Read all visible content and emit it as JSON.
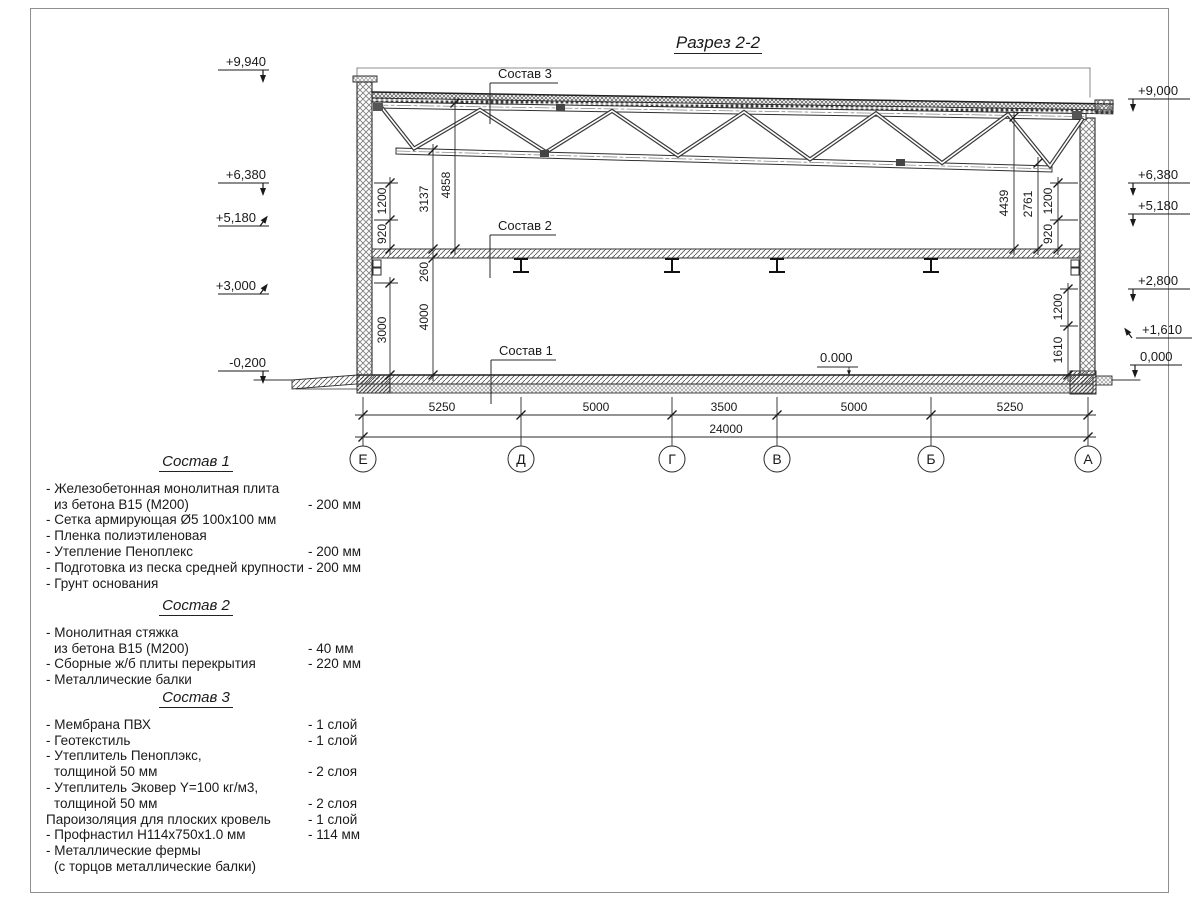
{
  "page": {
    "title": "Разрез 2-2"
  },
  "section_labels": {
    "sostav3": "Состав 3",
    "sostav2": "Состав 2",
    "sostav1": "Состав 1",
    "zero": "0.000"
  },
  "elevations": {
    "left": [
      "+9,940",
      "+6,380",
      "+5,180",
      "+3,000",
      "-0,200"
    ],
    "right": [
      "+9,000",
      "+6,380",
      "+5,180",
      "+2,800",
      "+1,610",
      "0,000"
    ]
  },
  "dimensions": {
    "left_upper": [
      "1200",
      "920",
      "3137",
      "4858"
    ],
    "left_lower": [
      "260",
      "3000",
      "4000"
    ],
    "right_upper": [
      "4439",
      "2761",
      "1200",
      "920"
    ],
    "right_lower": [
      "1200",
      "1610"
    ],
    "bottom": [
      "5250",
      "5000",
      "3500",
      "5000",
      "5250"
    ],
    "total": "24000"
  },
  "axes": [
    "Е",
    "Д",
    "Г",
    "В",
    "Б",
    "А"
  ],
  "compositions": [
    {
      "heading": "Состав 1",
      "rows": [
        {
          "text": "- Железобетонная  монолитная плита",
          "value": ""
        },
        {
          "text": "из бетона  В15 (М200)",
          "value": "- 200 мм"
        },
        {
          "text": "- Сетка армирующая Ø5 100х100 мм",
          "value": ""
        },
        {
          "text": "- Пленка полиэтиленовая",
          "value": ""
        },
        {
          "text": "- Утепление Пеноплекс",
          "value": "- 200 мм"
        },
        {
          "text": "- Подготовка из песка средней  крупности",
          "value": "- 200 мм"
        },
        {
          "text": "- Грунт основания",
          "value": ""
        }
      ]
    },
    {
      "heading": "Состав 2",
      "rows": [
        {
          "text": "- Монолитная стяжка",
          "value": ""
        },
        {
          "text": "из бетона В15 (М200)",
          "value": "- 40 мм"
        },
        {
          "text": "- Сборные ж/б плиты перекрытия",
          "value": "- 220 мм"
        },
        {
          "text": "- Металлические балки",
          "value": ""
        }
      ]
    },
    {
      "heading": "Состав 3",
      "rows": [
        {
          "text": "- Мембрана ПВХ",
          "value": "- 1 слой"
        },
        {
          "text": "- Геотекстиль",
          "value": "- 1 слой"
        },
        {
          "text": "- Утеплитель Пеноплэкс,",
          "value": ""
        },
        {
          "text": "толщиной 50 мм",
          "value": "- 2 слоя"
        },
        {
          "text": "- Утеплитель Эковер Y=100 кг/м3,",
          "value": ""
        },
        {
          "text": "толщиной 50 мм",
          "value": "- 2 слоя"
        },
        {
          "text": "Пароизоляция для плоских кровель",
          "value": "- 1 слой"
        },
        {
          "text": "- Профнастил Н114х750х1.0 мм",
          "value": "- 114 мм"
        },
        {
          "text": "- Металлические фермы",
          "value": ""
        },
        {
          "text": "(с торцов металлические балки)",
          "value": ""
        }
      ]
    }
  ]
}
